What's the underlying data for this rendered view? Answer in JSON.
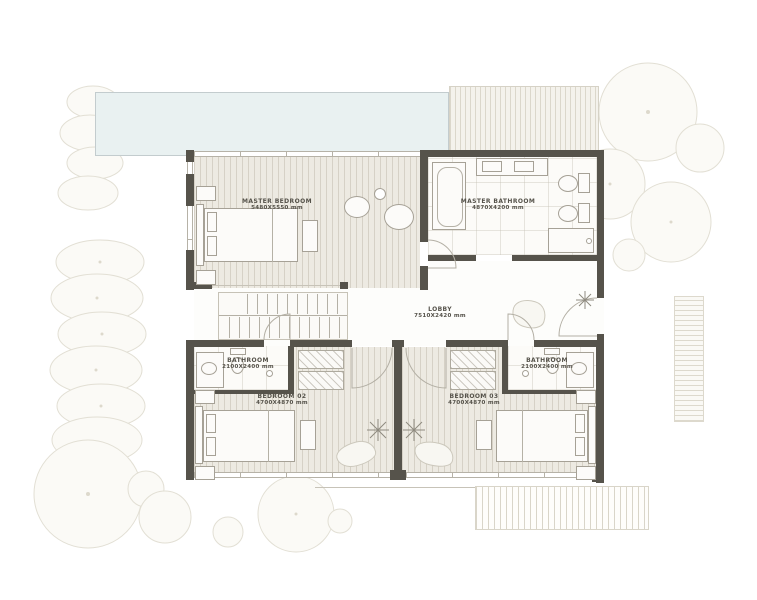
{
  "title": "Villa upper floor plan",
  "rooms": {
    "master_bedroom": {
      "label": "MASTER BEDROOM",
      "dims": "5480X5550 mm"
    },
    "master_bathroom": {
      "label": "MASTER BATHROOM",
      "dims": "4870X4200 mm"
    },
    "lobby": {
      "label": "LOBBY",
      "dims": "7510X2420 mm"
    },
    "bathroom_left": {
      "label": "BATHROOM",
      "dims": "2100X2400 mm"
    },
    "bathroom_right": {
      "label": "BATHROOM",
      "dims": "2100X2400 mm"
    },
    "bedroom_02": {
      "label": "BEDROOM 02",
      "dims": "4700X4870 mm"
    },
    "bedroom_03": {
      "label": "BEDROOM 03",
      "dims": "4700X4870 mm"
    }
  },
  "palette": {
    "wall": "#56534b",
    "pool": "#e9f1f1",
    "wood_floor": "#edeae2",
    "tile_floor": "#fcfbf8",
    "tree_outline": "#e2dfd4",
    "label_text": "#55524a"
  }
}
